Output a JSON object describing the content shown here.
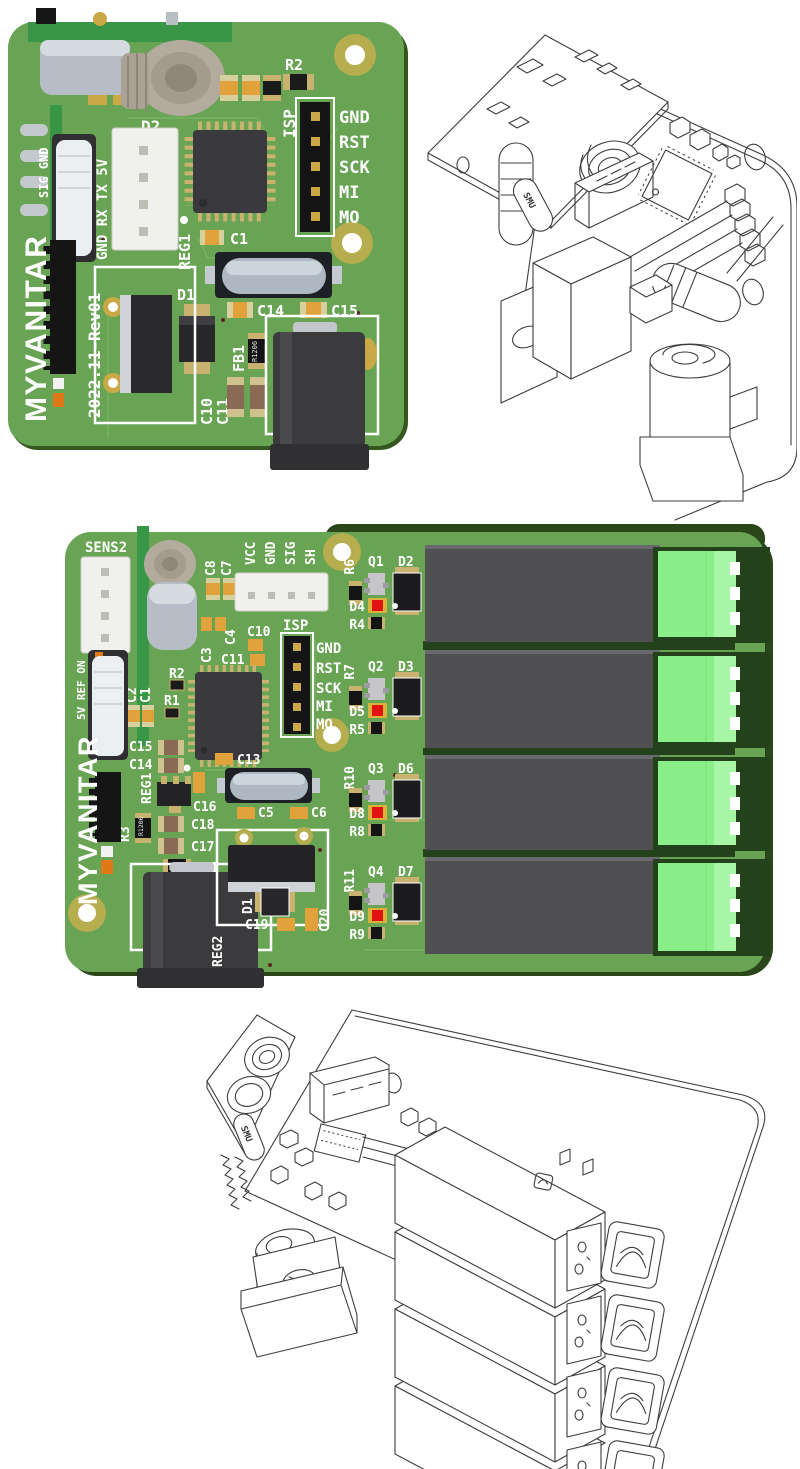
{
  "page_title": "PCB revision renders",
  "colors": {
    "board_green": "#69a455",
    "board_edge_green": "#2b4719",
    "daughter_green": "#3a9647",
    "relay_gray": "#505052",
    "terminal_green": "#8bef89",
    "led_red": "#e01212",
    "silkscreen_white": "#ffffff",
    "pad_gold": "#c9a845",
    "wireframe_stroke": "#3d3d3d"
  },
  "board1": {
    "brand": "MYVANITAR",
    "revision": "2022.11-Rev01",
    "edge_pins": "SIG GND",
    "serial_pins": "GND RX TX 5V",
    "isp": {
      "label": "ISP",
      "pins": [
        "GND",
        "RST",
        "SCK",
        "MI",
        "MO"
      ]
    },
    "refs": {
      "c2": "C2",
      "c3": "C3",
      "r1": "R1",
      "r2": "R2",
      "d2": "D2",
      "reg1": "REG1",
      "c1": "C1",
      "d1": "D1",
      "c14": "C14",
      "c15": "C15",
      "fb1": "FB1",
      "c10": "C10",
      "c11": "C11"
    },
    "footprint_text": "R1206"
  },
  "board2": {
    "brand": "MYVANITAR",
    "revision": "2022.12-Rev02",
    "sensor_label": "SENS2",
    "output_pins": [
      "VCC",
      "GND",
      "SIG",
      "SH"
    ],
    "edge_pins": "5V REF ON",
    "isp": {
      "label": "ISP",
      "pins": [
        "GND",
        "RST",
        "SCK",
        "MI",
        "MO"
      ]
    },
    "refs": {
      "c8": "C8",
      "c7": "C7",
      "c4": "C4",
      "c3": "C3",
      "c10": "C10",
      "c11": "C11",
      "r2": "R2",
      "r1": "R1",
      "c2": "C2",
      "c1": "C1",
      "c15": "C15",
      "c14": "C14",
      "reg1": "REG1",
      "c16": "C16",
      "c13": "C13",
      "c5": "C5",
      "c6": "C6",
      "r3": "R3",
      "c18": "C18",
      "c17": "C17",
      "fb1": "FB1",
      "reg2": "REG2",
      "d1": "D1",
      "c19": "C19",
      "c20": "C20"
    },
    "footprint_text": "R1206",
    "channels": [
      {
        "transistor": "Q1",
        "flyback_diode": "D2",
        "base_resistor": "R6",
        "led": "D4",
        "led_resistor": "R4"
      },
      {
        "transistor": "Q2",
        "flyback_diode": "D3",
        "base_resistor": "R7",
        "led": "D5",
        "led_resistor": "R5"
      },
      {
        "transistor": "Q3",
        "flyback_diode": "D6",
        "base_resistor": "R10",
        "led": "D8",
        "led_resistor": "R8"
      },
      {
        "transistor": "Q4",
        "flyback_diode": "D7",
        "base_resistor": "R11",
        "led": "D9",
        "led_resistor": "R9"
      }
    ]
  },
  "wireframes": {
    "crystal_text": "SMU"
  }
}
